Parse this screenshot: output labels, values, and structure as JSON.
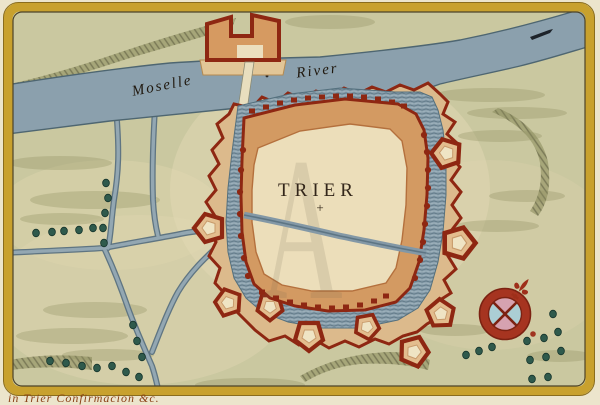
{
  "map": {
    "city_label": "TRIER",
    "city_cross": "+",
    "river_label_word1": "Moselle",
    "river_label_word2": "River",
    "watermark_letter": "A",
    "caption_fragment": "in Trier Confirmacion &c.",
    "colors": {
      "frame_gold": "#c8a12e",
      "terrain_olive": "#cac8a0",
      "paper_cream": "#e9dfc0",
      "water_blue": "#8ba0ad",
      "fortification_red": "#8e2712",
      "rampart_tan": "#d39a62",
      "city_interior": "#ecdeba",
      "tree_green": "#2f5a4c",
      "compass_pink": "#d6a2b0",
      "compass_blue": "#abced4",
      "ink_dark": "#2e2315",
      "caption_ink": "#8a4016"
    }
  }
}
